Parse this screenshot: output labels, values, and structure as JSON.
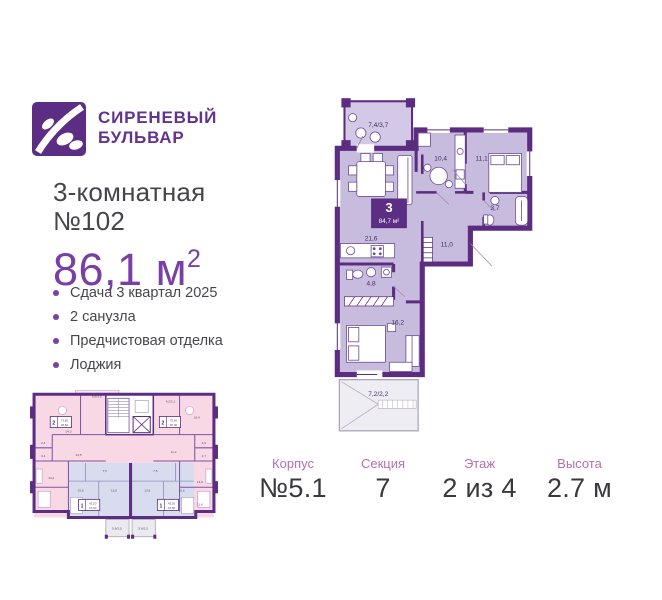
{
  "brand": {
    "name_line1": "СИРЕНЕВЫЙ",
    "name_line2": "БУЛЬВАР"
  },
  "listing": {
    "type_line1": "3-комнатная",
    "type_line2": "№102",
    "area_value": "86,1",
    "area_unit": " м",
    "area_sup": "2"
  },
  "features": {
    "items": [
      "Сдача 3 квартал 2025",
      "2 санузла",
      "Предчистовая отделка",
      "Лоджия"
    ]
  },
  "main_plan": {
    "badge": {
      "rooms": "3",
      "area": "84,7 м²"
    },
    "rooms": [
      {
        "name": "balcony-top",
        "label": "7,4/3,7"
      },
      {
        "name": "kitchen",
        "label": "10,4"
      },
      {
        "name": "bedroom-1",
        "label": "11,1"
      },
      {
        "name": "bathroom-1",
        "label": "3,7"
      },
      {
        "name": "living",
        "label": "21,6"
      },
      {
        "name": "hall",
        "label": "11,0"
      },
      {
        "name": "bathroom-2",
        "label": "4,8"
      },
      {
        "name": "bedroom-2",
        "label": "16,2"
      },
      {
        "name": "balcony-bottom",
        "label": "7,2/2,2"
      }
    ]
  },
  "mini_plan": {
    "balcony_labels": [
      "6,9/3,5",
      "4,2/2,1",
      "5,6/2,5",
      "5,6/2,5"
    ],
    "apartments": [
      {
        "rooms": "2",
        "area_total": "73,80",
        "area_living": "28,50"
      },
      {
        "rooms": "2",
        "area_total": "75,60",
        "area_living": "30,00"
      },
      {
        "rooms": "1",
        "area_total": "42,20",
        "area_living": "15,60"
      },
      {
        "rooms": "1",
        "area_total": "42,20",
        "area_living": "15,60"
      }
    ],
    "room_labels": [
      "14,3",
      "13,5",
      "2,4",
      "3,4",
      "14,2",
      "16,4",
      "11,2",
      "3,9",
      "2,7",
      "13,6",
      "11,6",
      "7,5",
      "15,6",
      "13,8",
      "7,5",
      "15,6",
      "13,8"
    ]
  },
  "details": {
    "items": [
      {
        "label": "Корпус",
        "value": "№5.1"
      },
      {
        "label": "Секция",
        "value": "7"
      },
      {
        "label": "Этаж",
        "value": "2 из 4"
      },
      {
        "label": "Высота",
        "value": "2.7 м"
      }
    ]
  },
  "colors": {
    "brand_purple": "#5b2d83",
    "wall_purple": "#5b2c80",
    "floor_lavender": "#c8bcde",
    "accent_text": "#7a3fa5",
    "mini_pink": "#f8d8e5",
    "mini_blue": "#d8dcee",
    "detail_label": "#b56fb0"
  }
}
